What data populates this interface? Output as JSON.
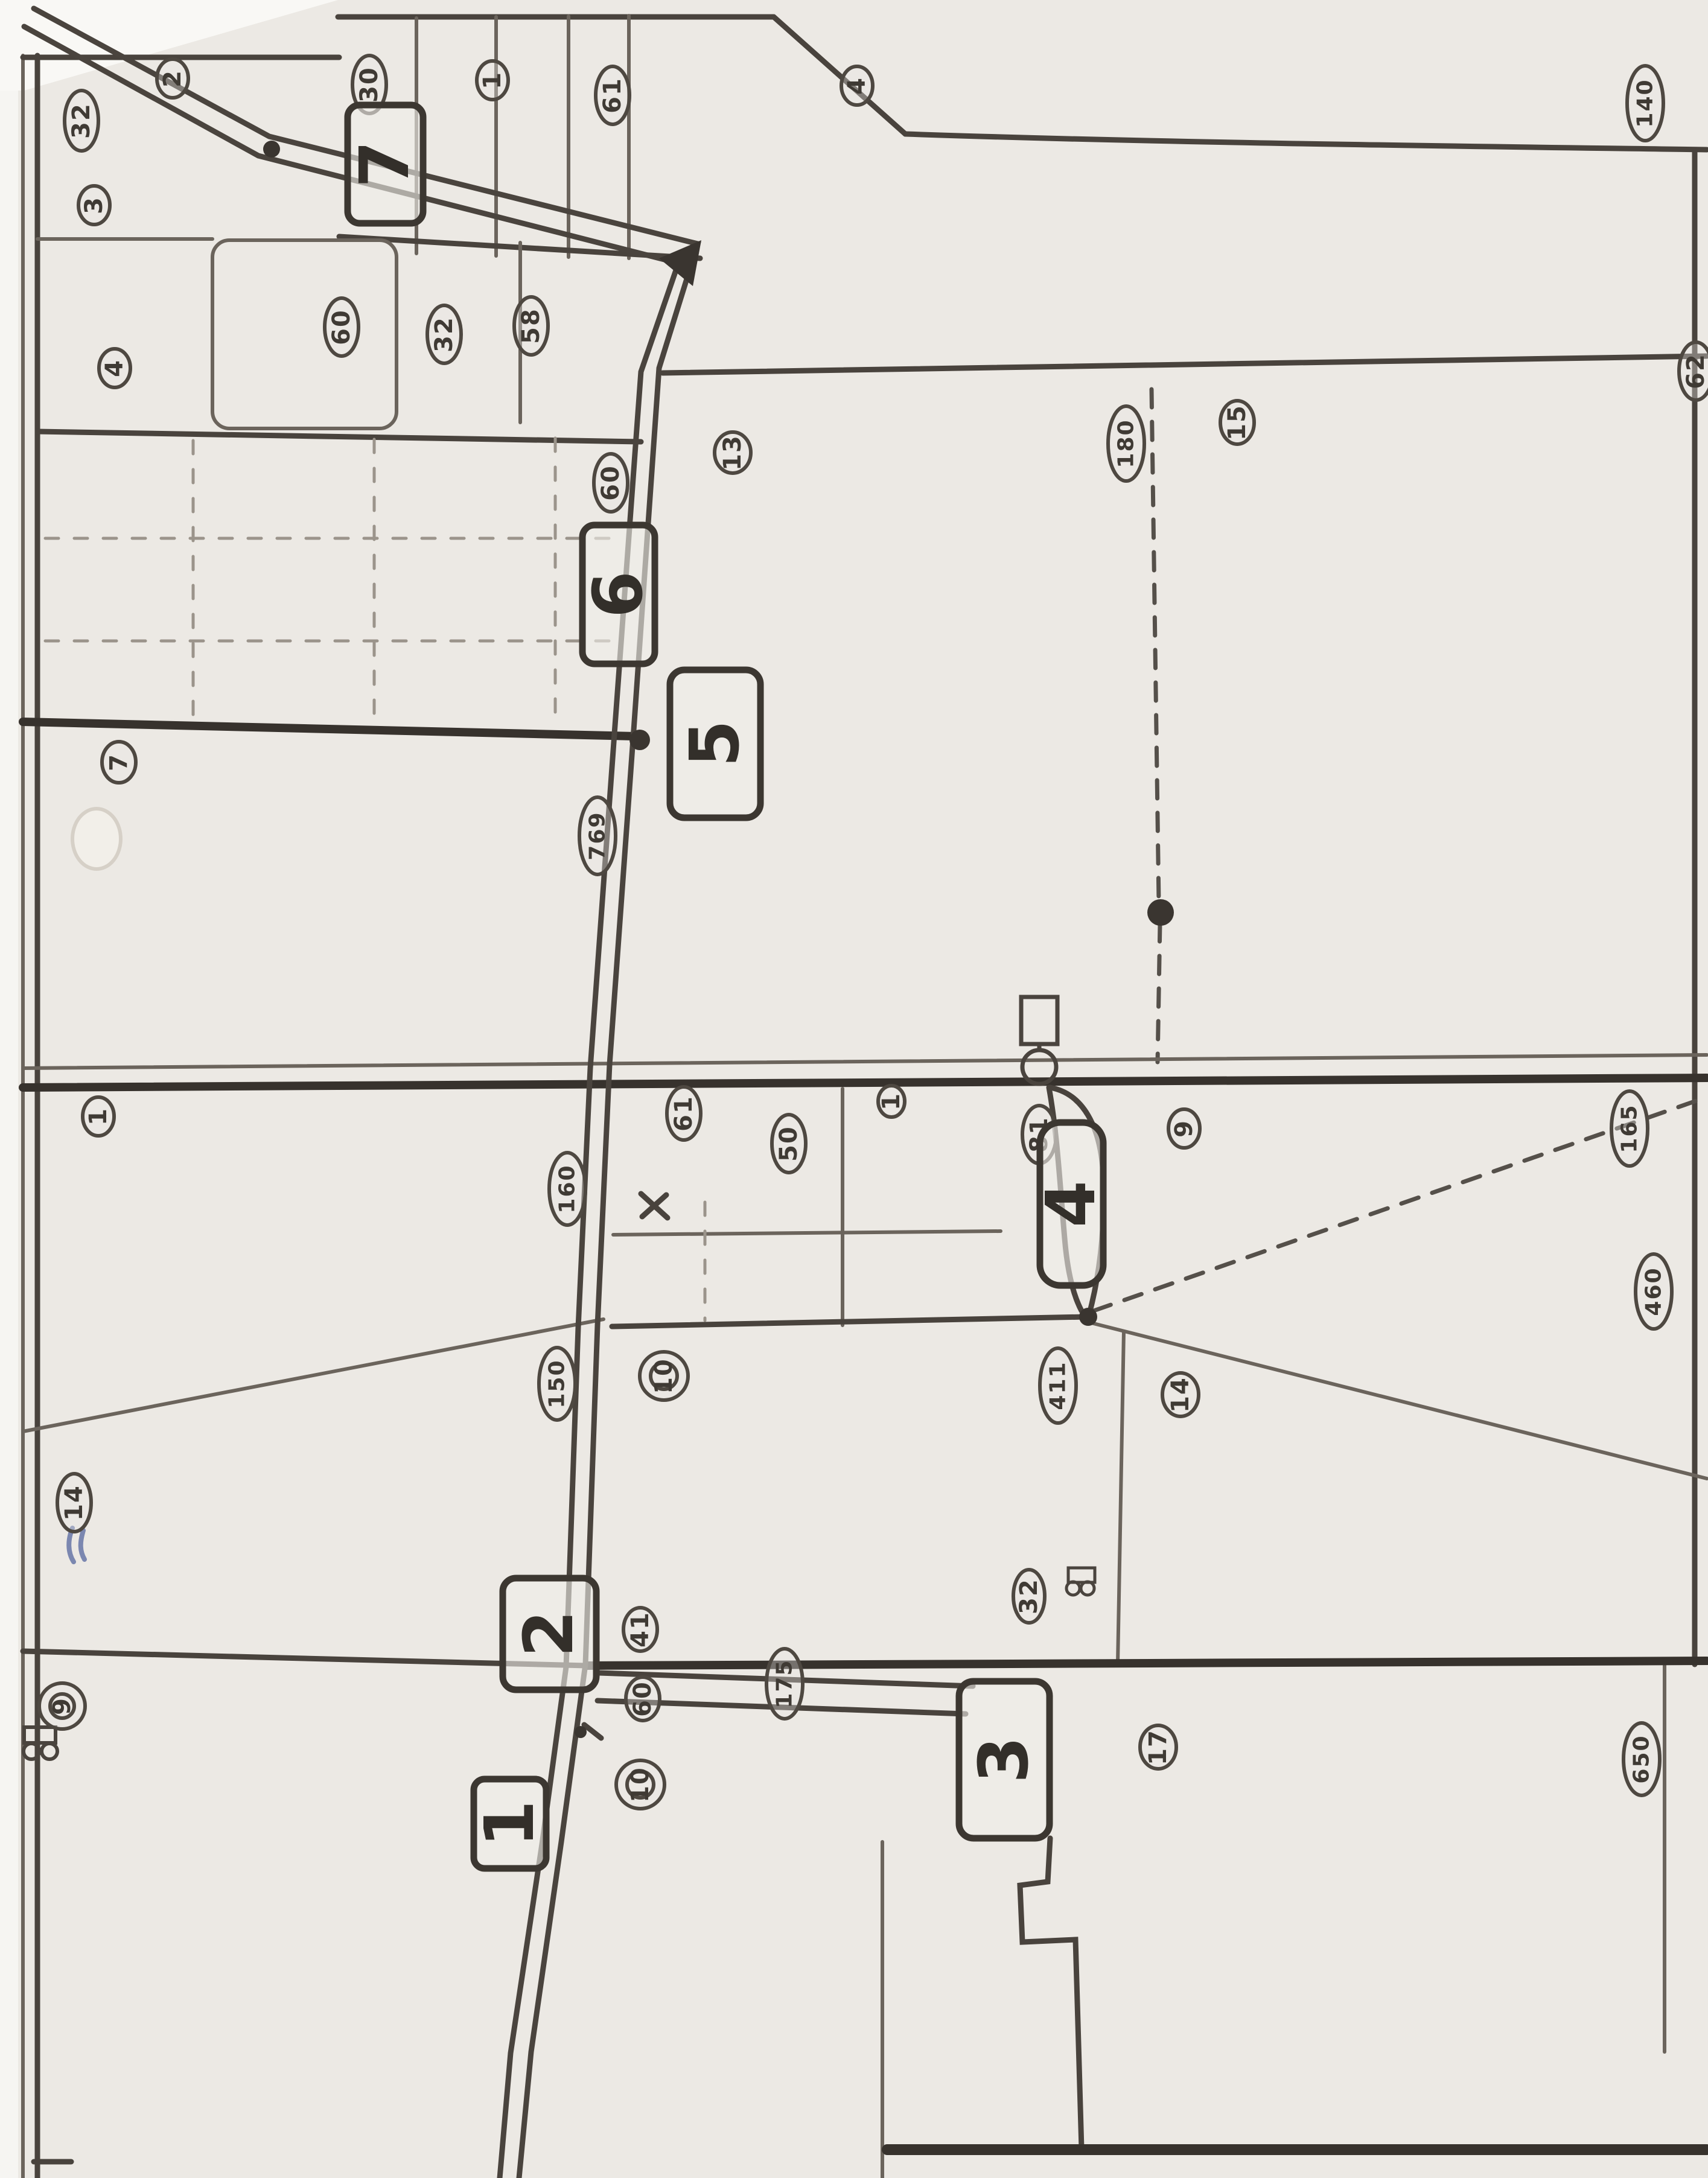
{
  "figure": {
    "kind": "scanned hand-drawn plat / survey map",
    "orientation": "content rotated 90 degrees counter-clockwise",
    "note": "numbered station boxes along a double-line road, circled parcel numbers, dashed boundary lines, junction dots, pump symbols"
  },
  "palette": {
    "paper": "#ece9e4",
    "ink_dark": "#37322d",
    "ink": "#49433d",
    "ink_light": "#6b645c",
    "blue_pen": "#7b87b0"
  },
  "boxes": [
    {
      "id": "station-7",
      "label": "7"
    },
    {
      "id": "station-6",
      "label": "6"
    },
    {
      "id": "station-5",
      "label": "5"
    },
    {
      "id": "station-4",
      "label": "4"
    },
    {
      "id": "station-2",
      "label": "2"
    },
    {
      "id": "station-3",
      "label": "3"
    },
    {
      "id": "station-1",
      "label": "1"
    }
  ],
  "ovals": [
    {
      "label": "32"
    },
    {
      "label": "2"
    },
    {
      "label": "3"
    },
    {
      "label": "30"
    },
    {
      "label": "1"
    },
    {
      "label": "61"
    },
    {
      "label": "4"
    },
    {
      "label": "140"
    },
    {
      "label": "62"
    },
    {
      "label": "60"
    },
    {
      "label": "32"
    },
    {
      "label": "58"
    },
    {
      "label": "4"
    },
    {
      "label": "60"
    },
    {
      "label": "13"
    },
    {
      "label": "180"
    },
    {
      "label": "15"
    },
    {
      "label": "7"
    },
    {
      "label": "769"
    },
    {
      "label": "1"
    },
    {
      "label": "165"
    },
    {
      "label": "81"
    },
    {
      "label": "9"
    },
    {
      "label": "61"
    },
    {
      "label": "50"
    },
    {
      "label": "1"
    },
    {
      "label": "460"
    },
    {
      "label": "160"
    },
    {
      "label": "150"
    },
    {
      "label": "10"
    },
    {
      "label": "411"
    },
    {
      "label": "14"
    },
    {
      "label": "14"
    },
    {
      "label": "41"
    },
    {
      "label": "60"
    },
    {
      "label": "10"
    },
    {
      "label": "175"
    },
    {
      "label": "32"
    },
    {
      "label": "17"
    },
    {
      "label": "9"
    },
    {
      "label": "650"
    }
  ]
}
